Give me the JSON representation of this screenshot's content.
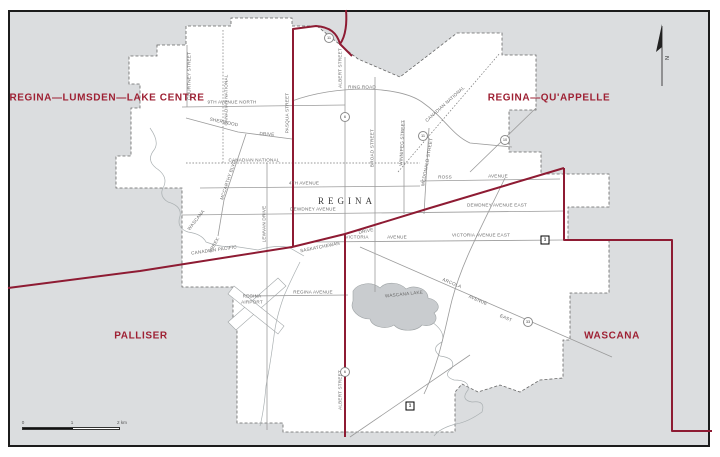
{
  "districts": {
    "nw": "REGINA—LUMSDEN—LAKE CENTRE",
    "ne": "REGINA—QU'APPELLE",
    "sw": "PALLISER",
    "se": "WASCANA"
  },
  "city_label": "REGINA",
  "labels": [
    {
      "text": "9TH AVENUE NORTH"
    },
    {
      "text": "COURTNEY STREET"
    },
    {
      "text": "CANADIAN NATIONAL"
    },
    {
      "text": "SHERWOOD"
    },
    {
      "text": "DRIVE"
    },
    {
      "text": "MCCARTHY BLVD"
    },
    {
      "text": "CANADIAN NATIONAL"
    },
    {
      "text": "4TH AVENUE"
    },
    {
      "text": "DEWDNEY AVENUE"
    },
    {
      "text": "DEWDNEY AVENUE EAST"
    },
    {
      "text": "VICTORIA"
    },
    {
      "text": "AVENUE"
    },
    {
      "text": "VICTORIA AVENUE EAST"
    },
    {
      "text": "SASKATCHEWAN"
    },
    {
      "text": "DRIVE"
    },
    {
      "text": "REGINA AVENUE"
    },
    {
      "text": "ALBERT STREET"
    },
    {
      "text": "ALBERT STREET"
    },
    {
      "text": "BROAD STREET"
    },
    {
      "text": "WINNIPEG STREET"
    },
    {
      "text": "MCDONALD STREET"
    },
    {
      "text": "CANADIAN NATIONAL"
    },
    {
      "text": "RING ROAD"
    },
    {
      "text": "ROSS"
    },
    {
      "text": "AVENUE"
    },
    {
      "text": "ARCOLA"
    },
    {
      "text": "AVENUE"
    },
    {
      "text": "EAST"
    },
    {
      "text": "WASCANA"
    },
    {
      "text": "CREEK"
    },
    {
      "text": "REGINA"
    },
    {
      "text": "AIRPORT"
    },
    {
      "text": "WASCANA LAKE"
    },
    {
      "text": "PASQUA STREET"
    },
    {
      "text": "LEWVAN DRIVE"
    },
    {
      "text": "CANADIAN PACIFIC"
    }
  ],
  "highway_shields": [
    {
      "num": "11"
    },
    {
      "num": "6"
    },
    {
      "num": "11"
    },
    {
      "num": "10"
    },
    {
      "num": "33"
    },
    {
      "num": "6"
    }
  ],
  "transcanada_shields": [
    {
      "num": "1"
    },
    {
      "num": "1"
    }
  ],
  "scale": {
    "t0": "0",
    "t1": "1",
    "t2": "2 km"
  },
  "north_letter": "N",
  "colors": {
    "boundary": "#8E1B33",
    "district_label": "#9E2033",
    "water": "#c9cccf"
  }
}
